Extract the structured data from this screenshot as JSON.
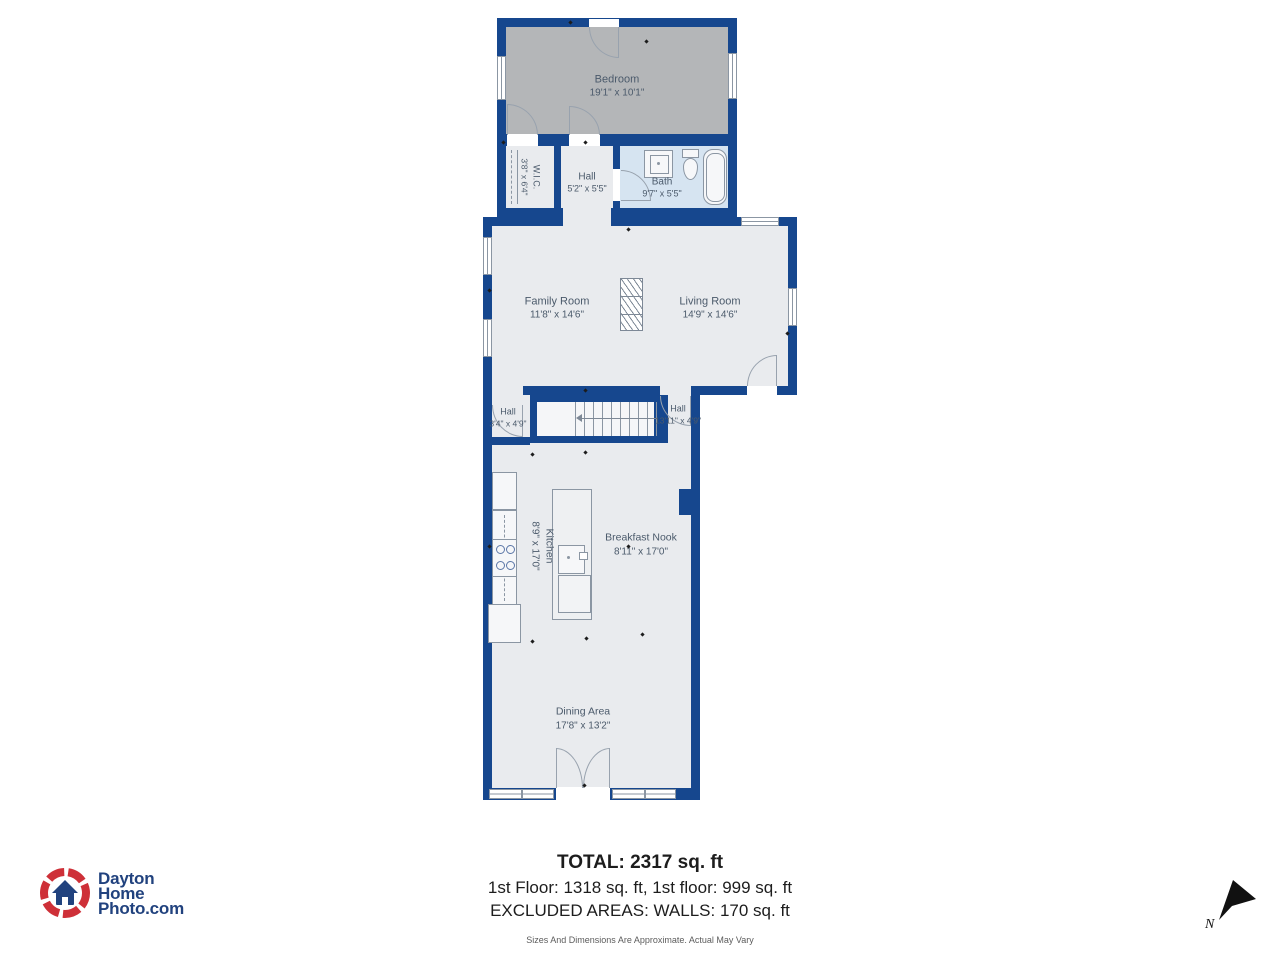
{
  "plan": {
    "rooms": [
      {
        "key": "bedroom",
        "name": "Bedroom",
        "dims": "19'1\" x 10'1\""
      },
      {
        "key": "wic",
        "name": "W.I.C.",
        "dims": "3'8\" x 6'4\""
      },
      {
        "key": "hall-upper",
        "name": "Hall",
        "dims": "5'2\" x 5'5\""
      },
      {
        "key": "bath",
        "name": "Bath",
        "dims": "9'7\" x 5'5\""
      },
      {
        "key": "family-room",
        "name": "Family Room",
        "dims": "11'8\" x 14'6\""
      },
      {
        "key": "living-room",
        "name": "Living Room",
        "dims": "14'9\" x 14'6\""
      },
      {
        "key": "hall-left",
        "name": "Hall",
        "dims": "3'4\" x 4'9\""
      },
      {
        "key": "hall-right",
        "name": "Hall",
        "dims": "13'11\" x 4'9\""
      },
      {
        "key": "kitchen",
        "name": "Kitchen",
        "dims": "8'9\" x 17'0\""
      },
      {
        "key": "breakfast-nook",
        "name": "Breakfast Nook",
        "dims": "8'11\" x 17'0\""
      },
      {
        "key": "dining-area",
        "name": "Dining Area",
        "dims": "17'8\" x 13'2\""
      }
    ]
  },
  "summary": {
    "total": "TOTAL: 2317 sq. ft",
    "floors": "1st Floor: 1318 sq. ft, 1st floor: 999 sq. ft",
    "excluded": "EXCLUDED AREAS: WALLS: 170 sq. ft",
    "disclaimer": "Sizes And Dimensions Are Approximate. Actual May Vary"
  },
  "branding": {
    "logo_line1": "Dayton",
    "logo_line2": "Home",
    "logo_line3": "Photo.com"
  },
  "compass": {
    "label": "N"
  },
  "colors": {
    "wall": "#16478e",
    "floor": "#e9ebee",
    "bedroom_floor": "#b4b6b8",
    "bath_floor": "#d6e4f1",
    "label_text": "#4b5a6b",
    "logo_red": "#ce3038",
    "logo_blue": "#21427e"
  }
}
